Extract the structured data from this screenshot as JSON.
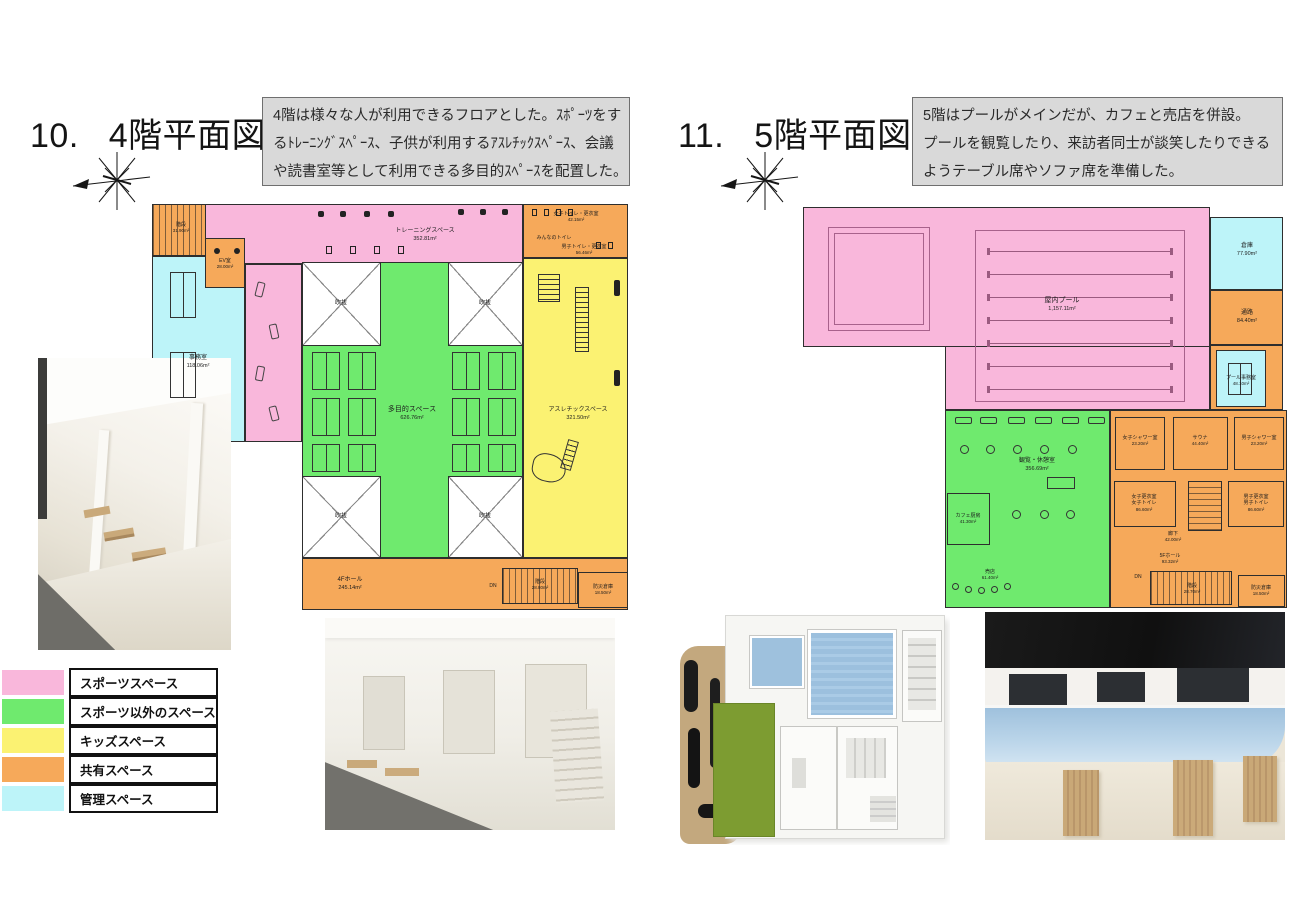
{
  "page": {
    "background": "#ffffff"
  },
  "palette": {
    "sports_pink": "#F9B7DB",
    "non_sports_green": "#6FEA6E",
    "kids_yellow": "#FBF272",
    "shared_orange": "#F6A95A",
    "admin_cyan": "#BDF4F9",
    "wall": "#2e2e2e",
    "note_bg": "#D9D9D9"
  },
  "left": {
    "number": "10.",
    "title": "4階平面図",
    "note_lines": [
      "4階は様々な人が利用できるフロアとした。ｽﾎﾟｰﾂをす",
      "るﾄﾚｰﾆﾝｸﾞｽﾍﾟｰｽ、子供が利用するｱｽﾚﾁｯｸｽﾍﾟｰｽ、会議",
      "や読書室等として利用できる多目的ｽﾍﾟｰｽを配置した。"
    ],
    "rooms": {
      "stairs_tl": {
        "name": "階段",
        "area": "31.90m²"
      },
      "office": {
        "name": "事務室",
        "area": "118.06m²"
      },
      "ev": {
        "name": "EV室",
        "area": "28.00m²"
      },
      "training": {
        "name": "トレーニングスペース",
        "area": "352.81m²"
      },
      "w_toilet": {
        "name": "女子トイレ・更衣室",
        "area": "42.15m²"
      },
      "minna_toilet": {
        "name": "みんなのトイレ"
      },
      "m_toilet": {
        "name": "男子トイレ・更衣室",
        "area": "56.46m²"
      },
      "void1": {
        "name": "吹抜"
      },
      "void2": {
        "name": "吹抜"
      },
      "void3": {
        "name": "吹抜"
      },
      "void4": {
        "name": "吹抜"
      },
      "multipurpose": {
        "name": "多目的スペース",
        "area": "626.76m²"
      },
      "athletic": {
        "name": "アスレチックスペース",
        "area": "321.50m²"
      },
      "hall": {
        "name": "4Fホール",
        "area": "245.14m²"
      },
      "dn": "DN",
      "stairs_b": {
        "name": "階段",
        "area": "28.80m²"
      },
      "storage": {
        "name": "防災倉庫",
        "area": "18.50m²"
      }
    }
  },
  "right": {
    "number": "11.",
    "title": "5階平面図",
    "note_lines": [
      "5階はプールがメインだが、カフェと売店を併設。",
      "プールを観覧したり、来訪者同士が談笑したりできる",
      "ようテーブル席やソファ席を準備した。"
    ],
    "rooms": {
      "pool": {
        "name": "屋内プール",
        "area": "1,157.11m²"
      },
      "storage_tr": {
        "name": "倉庫",
        "area": "77.90m²"
      },
      "corridor_r": {
        "name": "通路",
        "area": "84.40m²"
      },
      "pool_office": {
        "name": "プール事務室",
        "area": "48.10m²"
      },
      "lounge": {
        "name": "観覧・休憩室",
        "area": "356.69m²"
      },
      "cafe_kitchen": {
        "name": "カフェ厨房",
        "area": "41.30m²"
      },
      "shop": {
        "name": "売店",
        "area": "61.40m²"
      },
      "w_shower": {
        "name": "女子シャワー室",
        "area": "23.20m²"
      },
      "sauna": {
        "name": "サウナ",
        "area": "44.40m²"
      },
      "m_shower": {
        "name": "男子シャワー室",
        "area": "23.20m²"
      },
      "w_locker": {
        "name": "女子更衣室",
        "name2": "女子トイレ",
        "area": "86.60m²"
      },
      "m_locker": {
        "name": "男子更衣室",
        "name2": "男子トイレ",
        "area": "86.60m²"
      },
      "corridor_b": {
        "name": "廊下",
        "area": "42.00m²"
      },
      "hall": {
        "name": "5Fホール",
        "area": "93.32m²"
      },
      "dn": "DN",
      "stairs_b": {
        "name": "階段",
        "area": "28.70m²"
      },
      "storage_b": {
        "name": "防災倉庫",
        "area": "18.50m²"
      }
    }
  },
  "legend": {
    "items": [
      {
        "label": "スポーツスペース",
        "color": "#F9B7DB"
      },
      {
        "label": "スポーツ以外のスペース",
        "color": "#6FEA6E"
      },
      {
        "label": "キッズスペース",
        "color": "#FBF272"
      },
      {
        "label": "共有スペース",
        "color": "#F6A95A"
      },
      {
        "label": "管理スペース",
        "color": "#BDF4F9"
      }
    ]
  }
}
